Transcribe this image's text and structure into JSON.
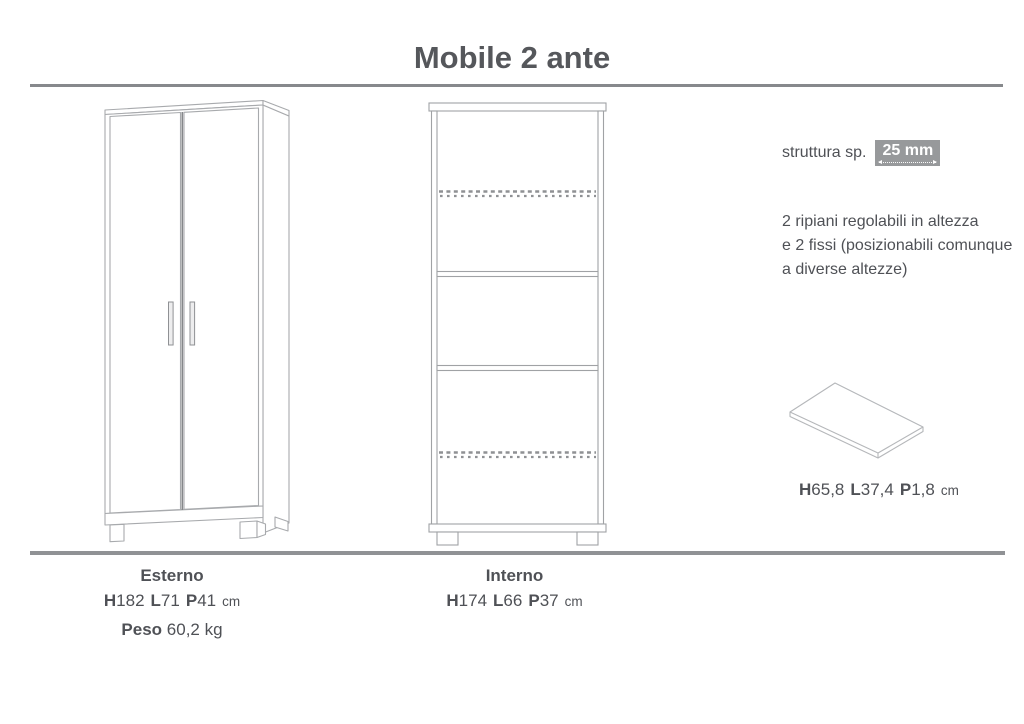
{
  "title": "Mobile 2 ante",
  "annotations": {
    "structure_label": "struttura sp.",
    "structure_value": "25 mm",
    "note_line1": "2 ripiani regolabili in altezza",
    "note_line2": "e 2 fissi (posizionabili comunque",
    "note_line3": "a diverse altezze)",
    "panel_dims": {
      "d0k": "H",
      "d0v": "65,8",
      "d1k": "L",
      "d1v": "37,4",
      "d2k": "P",
      "d2v": "1,8",
      "unit": "cm"
    }
  },
  "specs": {
    "esterno": {
      "title": "Esterno",
      "d0k": "H",
      "d0v": "182",
      "d1k": "L",
      "d1v": "71",
      "d2k": "P",
      "d2v": "41",
      "unit": "cm"
    },
    "peso": {
      "label": "Peso",
      "value": "60,2 kg"
    },
    "interno": {
      "title": "Interno",
      "d0k": "H",
      "d0v": "174",
      "d1k": "L",
      "d1v": "66",
      "d2k": "P",
      "d2v": "37",
      "unit": "cm"
    }
  },
  "colors": {
    "text": "#4f5156",
    "title": "#55575b",
    "rule": "#87898c",
    "drawing_line_light": "#a8aaad",
    "drawing_line_dark": "#8f9194",
    "badge_bg": "#97999b",
    "badge_text": "#ffffff",
    "background": "#ffffff"
  }
}
